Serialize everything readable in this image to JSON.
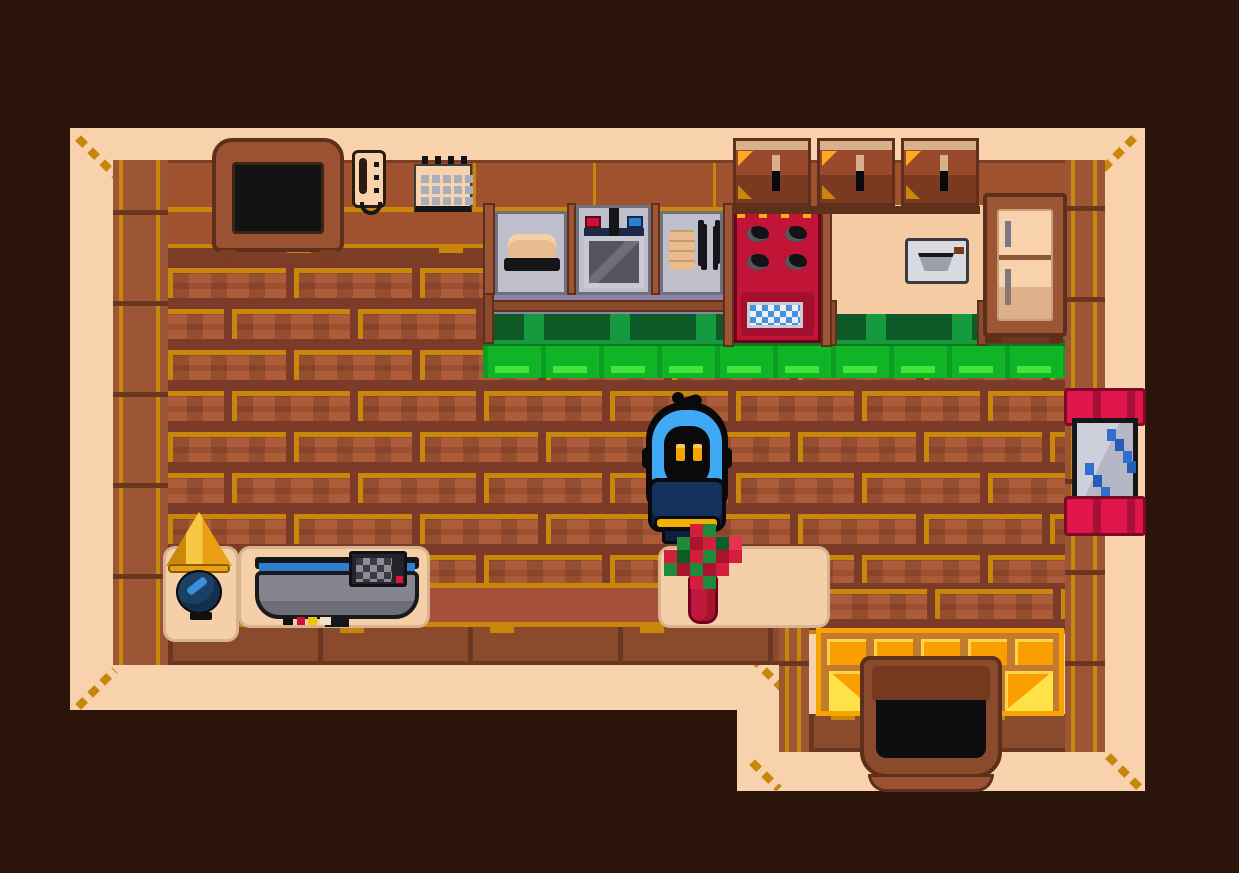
{
  "meta": {
    "app": "pixel-art adventure game",
    "view": "top-down wooden house interior",
    "visible_text": "none"
  },
  "palette": {
    "bg": "#2B150A",
    "cream": "#F7D2AC",
    "cream2": "#F5CBA4",
    "trim": "#8A4A2C",
    "trimDark": "#6B3720",
    "trimLight": "#9C5535",
    "trimEdge": "#5E2F1A",
    "gold": "#C8860A",
    "goldBright": "#FFA91E",
    "wall": "#A0522F",
    "wallDark": "#7C3E24",
    "mortar": "#7C3A28",
    "brick": "#AD5C39",
    "smooth": "#A4503A",
    "counterGray": "#BFBFCB",
    "counterEdge": "#70707C",
    "counterShadow": "#8D84A5",
    "steelDark": "#55555E",
    "slabGray": "#85858F",
    "greenDark": "#0D5A28",
    "greenMid": "#169A40",
    "green": "#0FB526",
    "greenLine": "#0B9E22",
    "greenLight": "#3FE53A",
    "greenTop": "#0A7A1A",
    "stoveRed": "#C11437",
    "stoveDark": "#A50F2E",
    "stoveEdge": "#70001E",
    "ovenBlue": "#4A90D9",
    "grayHandle": "#7A7A82",
    "windowRed": "#E0164A",
    "windowRedDark": "#A80F38",
    "windowRedEdge": "#7A0A28",
    "glassLight": "#CDD0DA",
    "glass": "#B5B8C4",
    "glassBlue": "#2E6FD0",
    "glassBlueDark": "#245CB8",
    "hoodBlue": "#3FA9F5",
    "cloak": "#15325C",
    "cloakDark": "#0C1F3D",
    "ink": "#0A0A0C",
    "eyeOrange": "#F5A300",
    "eyeLight": "#FFC64A",
    "trimGold": "#F0B000",
    "lampShade": "#E8A012",
    "lampShadeLight": "#F7C844",
    "lampShadeDark": "#C98A0A",
    "lampBase": "#1C3F66",
    "lampBaseLight": "#3A8FD9",
    "tableCream": "#F4CFA8",
    "tableEdge": "#D8B48E",
    "glowOrange": "#FB9E00",
    "glowBorder": "#F7A300",
    "glowYellow": "#FFD34D",
    "glowBright": "#FFE24A",
    "lattice": "#C17A2E",
    "doorBrown": "#8A4A2C",
    "doorLintel": "#74391F",
    "doorLip": "#9A5232",
    "tan": "#E8BC8F",
    "tanDark": "#C99A6C",
    "red": "#D41F3C",
    "redDark": "#A8142E",
    "redBright": "#E83050",
    "leaf": "#1F8A3A",
    "leafDark": "#0E5C28",
    "blueStripe": "#2E7FD0",
    "cabFace": "#9A4A2C",
    "cabHi": "#D9B08C",
    "cabLow": "#7A3A22",
    "tvFrame": "#9A5232"
  },
  "objects": {
    "room": {
      "label": "wooden house interior"
    },
    "tv": {
      "label": "wall-mounted TV"
    },
    "phone": {
      "label": "wall telephone"
    },
    "calendar": {
      "label": "wall calendar"
    },
    "cabinets": {
      "label": "overhead cabinets"
    },
    "cabinet_door": {
      "label": "cabinet door"
    },
    "counter": {
      "label": "counter with bread pan"
    },
    "sink": {
      "label": "kitchen sink with red and blue taps"
    },
    "counter_right": {
      "label": "counter with plates and utensils"
    },
    "stove": {
      "label": "red stove with oven"
    },
    "toaster": {
      "label": "wall toaster"
    },
    "fridge": {
      "label": "refrigerator"
    },
    "window": {
      "label": "window with red curtains"
    },
    "lamp": {
      "label": "lamp on side stand"
    },
    "media_table": {
      "label": "table with flat TV"
    },
    "console": {
      "label": "game console"
    },
    "table": {
      "label": "table with flower vase"
    },
    "vase": {
      "label": "flower vase"
    },
    "player": {
      "label": "hooded player character"
    },
    "door": {
      "label": "front door"
    },
    "mat": {
      "label": "golden doormat"
    },
    "hedge": {
      "label": "green cabinet hedge"
    },
    "floor": {
      "label": "brick wood floor"
    }
  }
}
